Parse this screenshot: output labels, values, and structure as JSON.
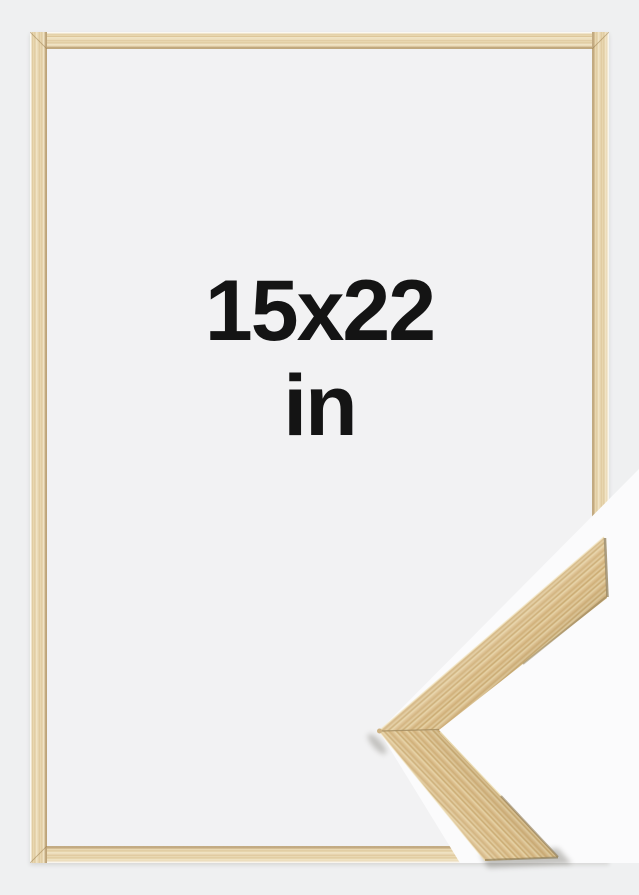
{
  "size_label": {
    "line1": "15x22",
    "line2": "in"
  },
  "colors": {
    "page_background": "#eff0f1",
    "frame_interior": "#f2f2f3",
    "corner_backdrop": "#fbfbfc",
    "frame_wood_light": "#ecdcba",
    "frame_wood_dark": "#ddc69a",
    "sample_wood_mid": "#d6b985",
    "sample_wood_dark": "#c1a268",
    "sample_wood_light": "#e9d7aa",
    "label_text": "#141414"
  }
}
